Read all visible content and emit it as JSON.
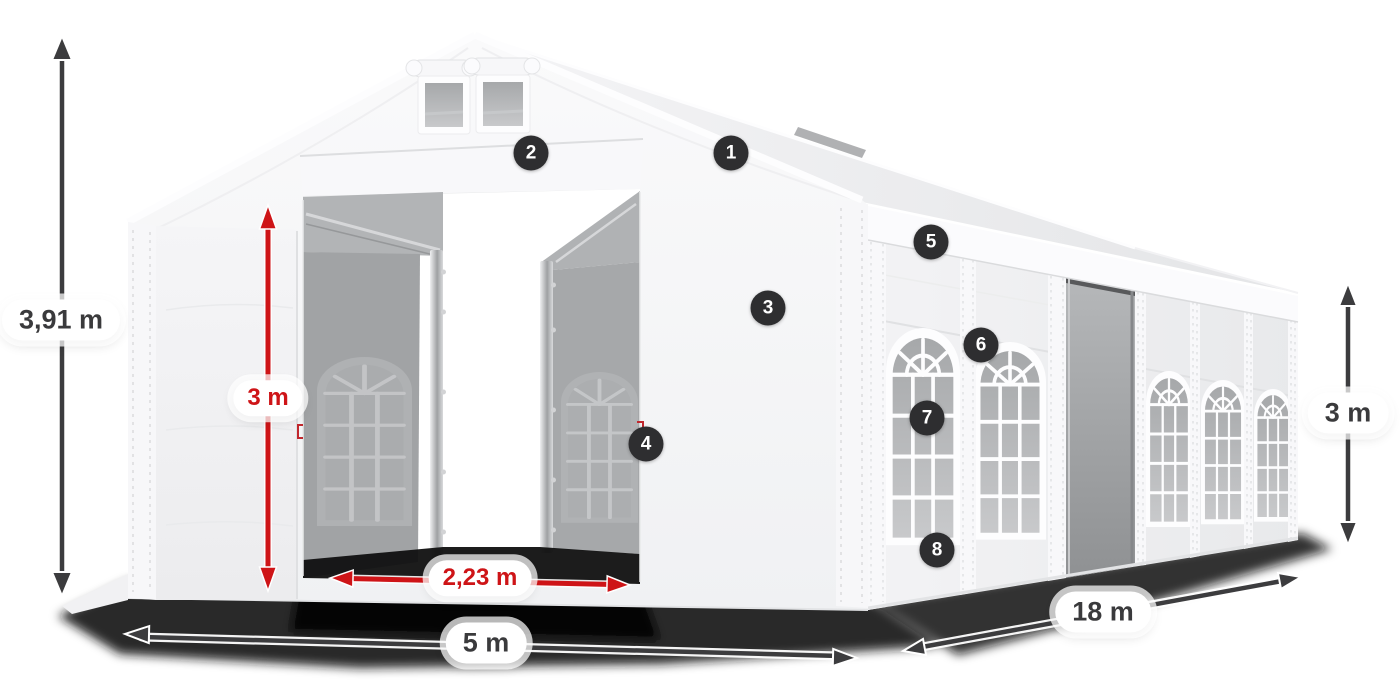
{
  "scene": {
    "background": "#ffffff",
    "subject": "white storage tent 5x18 m with open sliding doors, dimension arrows and numbered feature markers"
  },
  "colors": {
    "accent_red": "#ce1417",
    "arrow_dark": "#3c3c3e",
    "badge_bg": "#2e2e30",
    "tent_white": "#f5f5f7",
    "interior_gray": "#a3a5a7"
  },
  "dimensions": {
    "total_height": {
      "value": "3,91 m",
      "style": "dark"
    },
    "entrance_height": {
      "value": "3 m",
      "style": "red"
    },
    "entrance_width": {
      "value": "2,23 m",
      "style": "red"
    },
    "width": {
      "value": "5 m",
      "style": "dark"
    },
    "length": {
      "value": "18 m",
      "style": "dark"
    },
    "side_height": {
      "value": "3 m",
      "style": "dark"
    }
  },
  "markers": [
    {
      "label": "1"
    },
    {
      "label": "2"
    },
    {
      "label": "3"
    },
    {
      "label": "4"
    },
    {
      "label": "5"
    },
    {
      "label": "6"
    },
    {
      "label": "7"
    },
    {
      "label": "8"
    }
  ]
}
